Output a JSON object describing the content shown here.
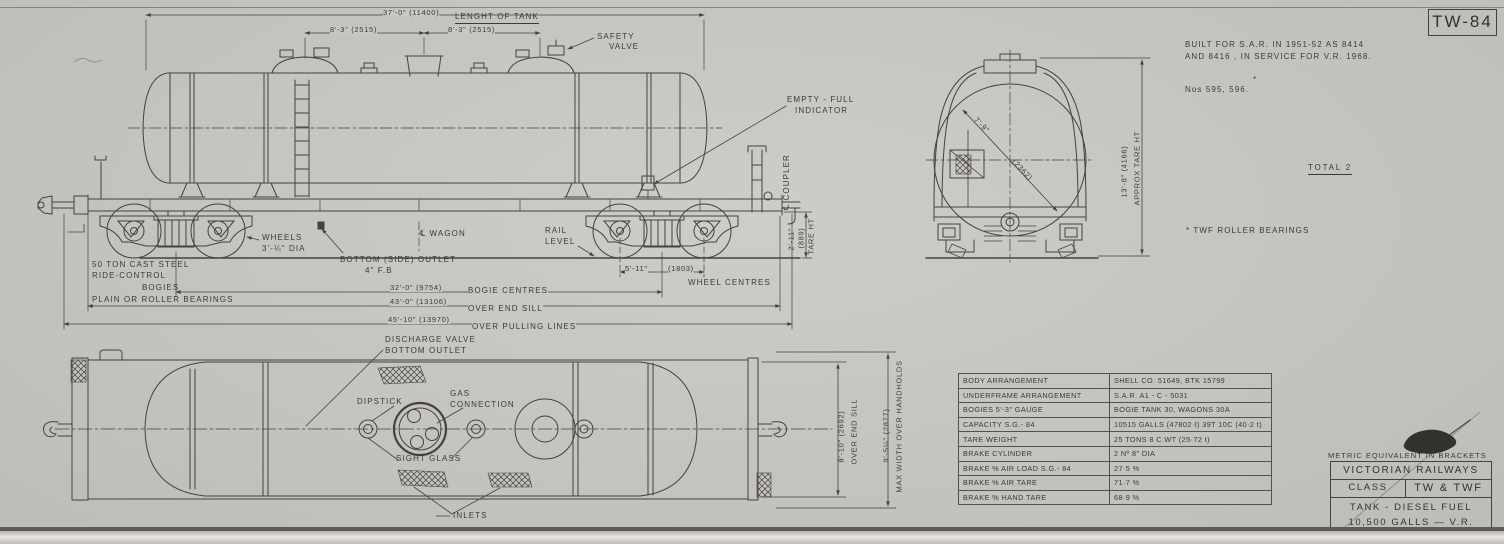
{
  "sheet": {
    "number": "TW-84",
    "background": "#c8c7c1",
    "ink": "#45423c"
  },
  "notes": {
    "built_line1": "BUILT FOR S.A.R. IN 1951-52 AS 8414",
    "built_line2": "AND 8416 , IN SERVICE FOR V.R. 1968.",
    "fleet_numbers": "Nos 595, 596.",
    "fleet_asterisk": "*",
    "total": "TOTAL 2",
    "bearings_note": "* TWF ROLLER BEARINGS",
    "metric_note": "METRIC EQUIVALENT IN BRACKETS"
  },
  "side": {
    "dim_tank_length": "37'-0\" (11400)",
    "label_tank_length": "LENGHT OF TANK",
    "dim_dome_left": "8'-3\" (2515)",
    "dim_dome_right": "8'-3\" (2515)",
    "safety_valve_1": "SAFETY",
    "safety_valve_2": "VALVE",
    "empty_full_1": "EMPTY - FULL",
    "empty_full_2": "INDICATOR",
    "coupler_cl": "℄ COUPLER",
    "tare_1": "2'-11\"",
    "tare_2": "(889)",
    "tare_3": "TARE HT",
    "rail_1": "RAIL",
    "rail_2": "LEVEL",
    "wagon_cl": "℄ WAGON",
    "wheels_1": "WHEELS",
    "wheels_2": "3'-¼\" DIA",
    "bogies_1": "50 TON CAST STEEL",
    "bogies_2": "RIDE-CONTROL",
    "bogies_3": "BOGIES",
    "bearings": "PLAIN OR ROLLER BEARINGS",
    "outlet_1": "BOTTOM (SIDE) OUTLET",
    "outlet_2": "4\" F.B",
    "wheel_centres_a": "5'-11\"",
    "wheel_centres_b": "(1803)",
    "wheel_centres_label": "WHEEL CENTRES",
    "bogie_centres": "32'-0\" (9754)",
    "bogie_centres_label": "BOGIE CENTRES",
    "over_end_sill": "43'-0\" (13106)",
    "over_end_sill_label": "OVER END SILL",
    "over_pulling": "45'-10\" (13970)",
    "over_pulling_label": "OVER PULLING LINES"
  },
  "end": {
    "dia_a": "7'-9\"",
    "dia_b": "(2362)",
    "ht_1": "13'-8\" (4166)",
    "ht_2": "APPROX TARE HT"
  },
  "plan": {
    "discharge_1": "DISCHARGE VALVE",
    "discharge_2": "BOTTOM OUTLET",
    "dipstick": "DIPSTICK",
    "gas_1": "GAS",
    "gas_2": "CONNECTION",
    "sight_glass": "SIGHT GLASS",
    "inlets": "INLETS",
    "over_end_sill_1": "8'-10\" (2692)",
    "over_end_sill_2": "OVER END SILL",
    "max_width_1": "9'-5¼\" (2877)",
    "max_width_2": "MAX WIDTH OVER HANDHOLDS"
  },
  "table": {
    "rows": [
      {
        "label": "BODY ARRANGEMENT",
        "value": "SHELL CO. 51649, BTK 15799"
      },
      {
        "label": "UNDERFRAME ARRANGEMENT",
        "value": "S.A.R. A1 - C - 5031"
      },
      {
        "label": "BOGIES 5'-3\" GAUGE",
        "value": "BOGIE TANK 30, WAGONS 30A"
      },
      {
        "label": "CAPACITY S.G.- 84",
        "value": "10515 GALLS (47802 ℓ) 39T 10C (40·2 t)"
      },
      {
        "label": "TARE WEIGHT",
        "value": "25 TONS 8 C.WT (25·72 t)"
      },
      {
        "label": "BRAKE CYLINDER",
        "value": "2 Nº 8\" DIA"
      },
      {
        "label": "BRAKE % AIR LOAD S.G.- 84",
        "value": "27·5 %"
      },
      {
        "label": "BRAKE % AIR TARE",
        "value": "71·7 %"
      },
      {
        "label": "BRAKE % HAND TARE",
        "value": "68·9 %"
      }
    ]
  },
  "title_block": {
    "company": "VICTORIAN RAILWAYS",
    "class_label": "CLASS",
    "class_value": "TW & TWF",
    "description_line1": "TANK - DIESEL FUEL",
    "description_line2": "10,500 GALLS — V.R."
  }
}
